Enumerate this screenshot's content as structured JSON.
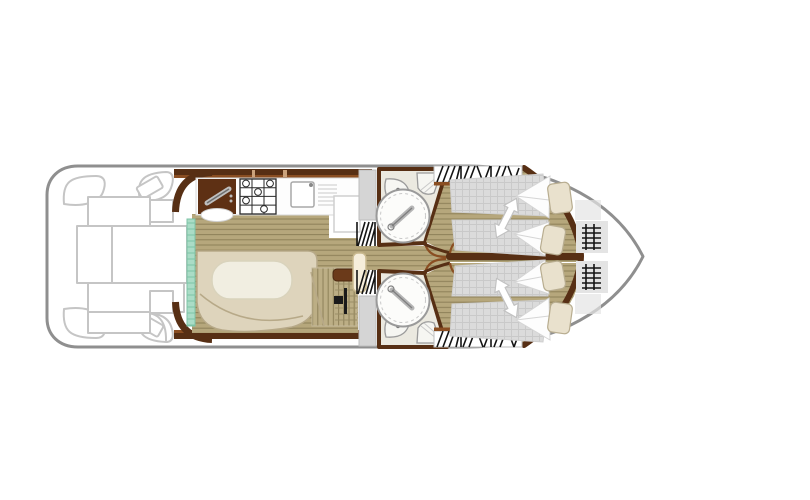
{
  "figure": {
    "kind": "boat-deck-floor-plan",
    "orientation": "bow-right-stern-left"
  },
  "palette": {
    "page_bg": "#ffffff",
    "hull_stroke": "#8f8f8f",
    "deck_stroke": "#c5c5c5",
    "wall_dark": "#572f14",
    "wall_light": "#8a4e22",
    "wood_base": "#b6a77c",
    "wood_line": "#8d8058",
    "teal_fill": "#aadcc6",
    "teal_stroke": "#7cc3a6",
    "bench_fill": "#ded4bc",
    "bench_stroke": "#b7a988",
    "table_fill": "#f1eee1",
    "table_stroke": "#d9d3bc",
    "bath_floor": "#ebe9e0",
    "fixture_stroke": "#9b9b9b",
    "mattress_fill": "#dbdbdb",
    "mattress_line": "#c9c9c9",
    "sheet_fill": "#fdfdfd",
    "sheet_stroke": "#d5d5d5",
    "pillow_fill": "#e9e1cd",
    "pillow_stroke": "#b8ad90",
    "arrow_fill": "#ffffff",
    "arrow_stroke": "#c2c2c2",
    "hatch_color": "#141414",
    "slab_fill": "#d5d5d5",
    "appliance_dark": "#5e3014",
    "stove_stroke": "#2a2a2a"
  },
  "icons": {
    "stove-icon": "4-burner-hob-grid",
    "sink-icon": "basin-with-drainer-lines",
    "fridge-icon": "outlined-square",
    "galley-cabinet-icon": "dark-cabinet-with-diagonal-handle",
    "shower-icon": "circle-with-shower-wand",
    "washbasin-icon": "corner-basin-with-tap-dot",
    "toilet-icon": "corner-wedge-with-lid-lines",
    "wardrobe-hatch-icon": "black-diagonal-hatching",
    "steps-hatch-icon": "black-diagonal-hatching-vertical",
    "bed-slide-arrow-icon": "white-double-headed-arrow",
    "bow-rail-icon": "ladder-hash-marks",
    "sliding-door-icon": "teal-ticked-strip"
  }
}
